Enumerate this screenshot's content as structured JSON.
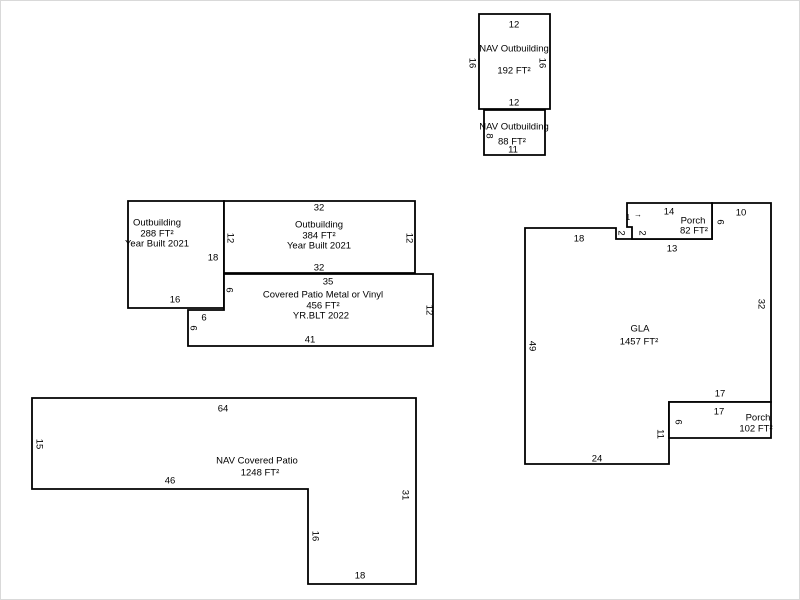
{
  "meta": {
    "description": "Property appraisal building sketch",
    "background": "#ffffff",
    "line_color": "#000000",
    "canvas": {
      "width": 800,
      "height": 600
    }
  },
  "shapes": [
    {
      "name": "nav-outbuilding-192",
      "points": "478,13 549,13 549,108 478,108",
      "labels": [
        {
          "text": "12",
          "x": 513,
          "y": 24
        },
        {
          "text": "NAV Outbuilding",
          "x": 513,
          "y": 48
        },
        {
          "text": "16",
          "x": 471,
          "y": 62,
          "rot": 90
        },
        {
          "text": "16",
          "x": 541,
          "y": 62,
          "rot": 90
        },
        {
          "text": "192 FT²",
          "x": 513,
          "y": 70
        },
        {
          "text": "12",
          "x": 513,
          "y": 102
        }
      ]
    },
    {
      "name": "nav-outbuilding-88",
      "points": "483,109 544,109 544,154 483,154",
      "labels": [
        {
          "text": "NAV Outbuilding",
          "x": 513,
          "y": 126
        },
        {
          "text": "8",
          "x": 488,
          "y": 135,
          "rot": 90
        },
        {
          "text": "88 FT²",
          "x": 511,
          "y": 141
        },
        {
          "text": "11",
          "x": 512,
          "y": 149
        }
      ]
    },
    {
      "name": "outbuilding-288",
      "points": "127,200 223,200 223,307 127,307",
      "labels": [
        {
          "text": "Outbuilding",
          "x": 156,
          "y": 222
        },
        {
          "text": "288 FT²",
          "x": 156,
          "y": 233
        },
        {
          "text": "Year Built 2021",
          "x": 156,
          "y": 243
        },
        {
          "text": "18",
          "x": 212,
          "y": 257
        },
        {
          "text": "16",
          "x": 174,
          "y": 299
        }
      ]
    },
    {
      "name": "outbuilding-384",
      "points": "223,200 414,200 414,272 223,272",
      "labels": [
        {
          "text": "32",
          "x": 318,
          "y": 207
        },
        {
          "text": "Outbuilding",
          "x": 318,
          "y": 224
        },
        {
          "text": "12",
          "x": 229,
          "y": 237,
          "rot": 90
        },
        {
          "text": "384 FT²",
          "x": 318,
          "y": 235
        },
        {
          "text": "Year Built 2021",
          "x": 318,
          "y": 245
        },
        {
          "text": "12",
          "x": 408,
          "y": 237,
          "rot": 90
        },
        {
          "text": "32",
          "x": 318,
          "y": 267
        }
      ]
    },
    {
      "name": "covered-patio-456",
      "points": "223,273 432,273 432,345 187,345 187,309 223,309",
      "labels": [
        {
          "text": "35",
          "x": 327,
          "y": 281
        },
        {
          "text": "6",
          "x": 228,
          "y": 289,
          "rot": 90
        },
        {
          "text": "Covered Patio Metal or Vinyl",
          "x": 322,
          "y": 294
        },
        {
          "text": "456 FT²",
          "x": 322,
          "y": 305
        },
        {
          "text": "YR.BLT 2022",
          "x": 320,
          "y": 315
        },
        {
          "text": "12",
          "x": 428,
          "y": 309,
          "rot": 90
        },
        {
          "text": "6",
          "x": 203,
          "y": 317
        },
        {
          "text": "6",
          "x": 192,
          "y": 327,
          "rot": 90
        },
        {
          "text": "41",
          "x": 309,
          "y": 339
        }
      ]
    },
    {
      "name": "nav-covered-patio-1248",
      "points": "31,397 415,397 415,583 307,583 307,488 31,488",
      "labels": [
        {
          "text": "64",
          "x": 222,
          "y": 408
        },
        {
          "text": "15",
          "x": 38,
          "y": 443,
          "rot": 90
        },
        {
          "text": "NAV Covered Patio",
          "x": 256,
          "y": 460
        },
        {
          "text": "1248 FT²",
          "x": 259,
          "y": 472
        },
        {
          "text": "46",
          "x": 169,
          "y": 480
        },
        {
          "text": "31",
          "x": 404,
          "y": 494,
          "rot": 90
        },
        {
          "text": "16",
          "x": 314,
          "y": 535,
          "rot": 90
        },
        {
          "text": "18",
          "x": 359,
          "y": 575
        }
      ]
    },
    {
      "name": "gla-1457",
      "points": "524,227 615,227 615,238 711,238 711,202 770,202 770,401 668,401 668,463 524,463",
      "labels": [
        {
          "text": "18",
          "x": 578,
          "y": 238
        },
        {
          "text": "2",
          "x": 620,
          "y": 232,
          "rot": 90
        },
        {
          "text": "1",
          "x": 627,
          "y": 217,
          "size": 8
        },
        {
          "text": "→",
          "x": 637,
          "y": 214,
          "size": 8
        },
        {
          "text": "2",
          "x": 641,
          "y": 232,
          "rot": 90
        },
        {
          "text": "13",
          "x": 671,
          "y": 248
        },
        {
          "text": "10",
          "x": 740,
          "y": 212
        },
        {
          "text": "GLA",
          "x": 639,
          "y": 328
        },
        {
          "text": "1457 FT²",
          "x": 638,
          "y": 341
        },
        {
          "text": "49",
          "x": 531,
          "y": 345,
          "rot": 90
        },
        {
          "text": "32",
          "x": 760,
          "y": 303,
          "rot": 90
        },
        {
          "text": "17",
          "x": 719,
          "y": 393
        },
        {
          "text": "11",
          "x": 659,
          "y": 433,
          "rot": 90
        },
        {
          "text": "24",
          "x": 596,
          "y": 458
        }
      ]
    },
    {
      "name": "porch-82",
      "points": "626,202 711,202 711,238 631,238 631,226 626,226",
      "labels": [
        {
          "text": "14",
          "x": 668,
          "y": 211
        },
        {
          "text": "Porch",
          "x": 692,
          "y": 220
        },
        {
          "text": "82 FT²",
          "x": 693,
          "y": 230
        },
        {
          "text": "6",
          "x": 719,
          "y": 221,
          "rot": 90
        }
      ]
    },
    {
      "name": "porch-102",
      "points": "668,401 770,401 770,437 668,437",
      "labels": [
        {
          "text": "17",
          "x": 718,
          "y": 411
        },
        {
          "text": "6",
          "x": 677,
          "y": 421,
          "rot": 90
        },
        {
          "text": "Porch",
          "x": 757,
          "y": 417
        },
        {
          "text": "102 FT²",
          "x": 755,
          "y": 428
        }
      ]
    }
  ]
}
